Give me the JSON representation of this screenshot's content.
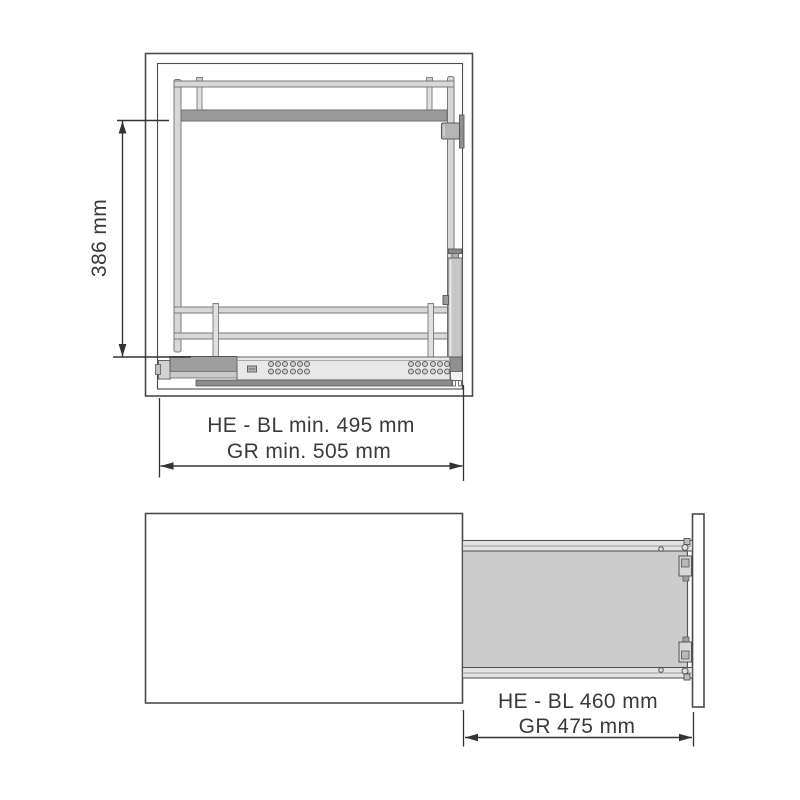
{
  "drawing": {
    "kind": "technical-installation-drawing",
    "subject": "cabinet pull-out wire frame with drawer runner",
    "colors": {
      "background": "#ffffff",
      "cabinet_line": "#4a4a4a",
      "dimension_line": "#333333",
      "dimension_text": "#3a3a3a",
      "tube_fill": "#d8d8d8",
      "shelf_fill": "#9a9a9a",
      "runner_fill": "#e8e8e8",
      "runner_block_fill": "#9e9e9e",
      "damper_fill": "#c6c6c6",
      "tray_fill": "#cccccc"
    }
  },
  "views": {
    "front": {
      "label": "front section view",
      "dims": {
        "height": "386 mm",
        "runner": "HE - BL min. 495 mm",
        "body": "GR min. 505 mm"
      }
    },
    "plan": {
      "label": "extended pull-out plan view",
      "dims": {
        "runner": "HE - BL 460 mm",
        "body": "GR 475 mm"
      }
    }
  }
}
